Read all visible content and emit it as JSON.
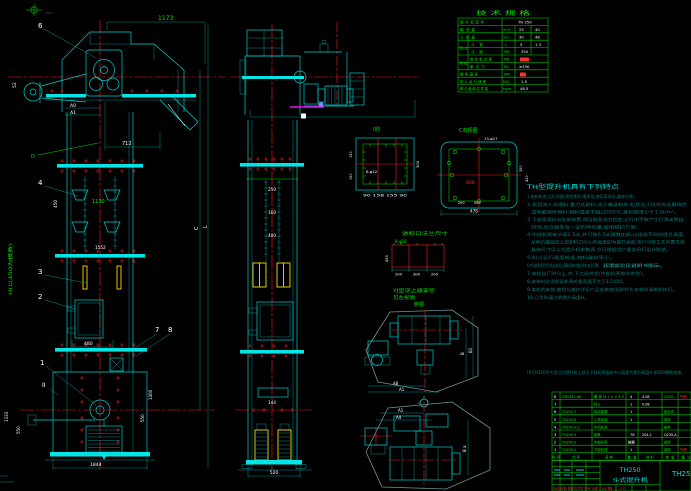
{
  "spec_table": {
    "title": "技 术 规 格",
    "rows": [
      {
        "group": "",
        "l": "提升机型号",
        "u": "",
        "v1": "TH 250",
        "v2": ""
      },
      {
        "group": "",
        "l": "输送量",
        "u": "m³/h",
        "v1": "25",
        "v2": "40"
      },
      {
        "group": "",
        "l": "斗提量",
        "u": "mm",
        "v1": "30",
        "v2": "48"
      },
      {
        "group": "料斗",
        "l": "斗 宽",
        "u": "L",
        "v1": "5",
        "v2": "1.3"
      },
      {
        "group": "",
        "l": "斗 距",
        "u": "MM",
        "v1": "350",
        "v2": ""
      },
      {
        "group": "电机",
        "l": "电动机功率",
        "u": "KW",
        "v1": "▇▇▇",
        "v2": ""
      },
      {
        "group": "",
        "l": "牵引力",
        "u": "KN",
        "v1": "≥330",
        "v2": ""
      },
      {
        "group": "",
        "l": "链条直径",
        "u": "MM",
        "v1": "▇▇",
        "v2": ""
      },
      {
        "group": "",
        "l": "料斗运行速度",
        "u": "M/S",
        "v1": "1.5",
        "v2": ""
      },
      {
        "group": "",
        "l": "牵引链单位质量",
        "u": "kg/m",
        "v1": "48.5",
        "v2": ""
      }
    ]
  },
  "notes": {
    "title": "TH型提升机具有下列特点",
    "lines": [
      "1.结构先进,运行平稳,密封性好,噪声低,使用寿命长,维修方便。",
      "2.采用流入式喂料,重力式卸料,适于输送粉状,粒状及小块状的无磨琢性",
      "或半磨琢性物料,物料温度不超过250℃,堆积密度小于1.5t/m³。",
      "3.下部采用自动张紧装置,保证链条张力恒定,运行中不致产生打滑或脱链,",
      "同时,允许链条有一定的伸长量,使用维护方便。",
      "4.中部机壳每节高2.5米,并可按0.5米模数加高,以组成不同的提升高度,",
      "从地坑基础至上部卸料口中心的高度即为提升高度,用户可按工艺布置选用,",
      "具体尺寸见斗式提升机参数表,亦可根据用户要求另行设计制造。",
      "5.料斗运行速度较低,物料破碎率小。",
      "6.传动装置采用YJ型逆止器,防止满载停车时链条逆转,安全可靠,",
      "7.本机出厂时分上,中,下三段供货(中部机壳按节供货)。",
      "8.安装时必须保证机壳的垂直度不大于1/1000。",
      "9.本机的安装,使用与维护详见产品安装使用说明书,安装时请参照执行。",
      "10.订货时请注明提升高度H。"
    ],
    "highlight": "润滑部位见说明书图示。",
    "footer": "(9)TH250中大型斗式提升机上部与下部机壳链轮中心距即为提升高度H,按450模数递增。"
  },
  "parts_table": {
    "headers": [
      "件号",
      "代  号",
      "名  称",
      "数量",
      "材  料",
      "单重",
      "备注"
    ],
    "rows": [
      {
        "no": "8",
        "code": "GB5782-86",
        "name": "螺栓M20×85",
        "qty": "4",
        "mat": "Q235",
        "wt": "4.08",
        "note": "外购"
      },
      {
        "no": "7",
        "code": "",
        "name": "料斗",
        "qty": "1",
        "mat": "",
        "wt": "0.08",
        "note": ""
      },
      {
        "no": "6",
        "code": "TH250.7",
        "name": "传动装置",
        "qty": "1",
        "mat": "组合件",
        "wt": "",
        "note": ""
      },
      {
        "no": "5",
        "code": "TH250.6",
        "name": "上部区段",
        "qty": "1",
        "mat": "部件",
        "wt": "",
        "note": ""
      },
      {
        "no": "4",
        "code": "TH250.4.5",
        "name": "中间机壳",
        "qty": "",
        "mat": "部件",
        "wt": "",
        "note": ""
      },
      {
        "no": "3",
        "code": "TH250.3",
        "name": "链条",
        "qty": "78",
        "mat": "Q235-A",
        "wt": "204.2",
        "note": ""
      },
      {
        "no": "2",
        "code": "TH250.2",
        "name": "中部机壳",
        "qty": "按需",
        "mat": "部件",
        "wt": "",
        "note": ""
      },
      {
        "no": "1",
        "code": "TH250.1",
        "name": "下部区段",
        "qty": "1",
        "mat": "部件",
        "wt": "",
        "note": "外购"
      }
    ]
  },
  "title_block": {
    "model": "TH250",
    "product": "斗式提升机",
    "drawing_no": "TH250",
    "rev_row": "标记 处数 更改文件号 签字 日期",
    "scale": "比例 1:10"
  },
  "balloons": {
    "b1": "1",
    "b2": "2",
    "b3": "3",
    "b4": "4",
    "b6": "6",
    "b7": "7",
    "b8": "8"
  },
  "dims": {
    "d1173": "1173",
    "d712": "712",
    "dA0": "A0",
    "dA1": "A1",
    "d52": "52",
    "d480": "480",
    "d1844": "1844",
    "d450": "450",
    "d1130": "1130",
    "d1552": "1552",
    "hModule": "H(以450为模数)",
    "d1333": "1333",
    "d550L": "550",
    "d1400": "1400",
    "d550R": "550",
    "letterC": "C",
    "letterL": "L",
    "sec": "II",
    "dD": "D",
    "mid250": "250",
    "mid160": "160",
    "mid400": "400",
    "mid144": "144",
    "mid520": "520",
    "f1_label": "I向",
    "f1_holes": "8-φ12",
    "f1_bottom": "90 158 155 90",
    "f1_right": "300",
    "f1_l1": "150",
    "f1_l2": "150",
    "c_label": "C向视图",
    "c_holes": "13-φ17",
    "c_600": "600",
    "c_478": "478",
    "c_350": "350",
    "c_420": "420",
    "c_b1": "250",
    "c_b2": "500",
    "feed_title": "进料口法兰尺寸",
    "feed_holes": "8-φ18",
    "feed_w1": "200",
    "feed_w2": "300",
    "feed_w3": "200",
    "feed_h": "450",
    "yj1": "YJ型逆止器安装",
    "yj2": "见左视图",
    "plan1_label": "俯视",
    "p1_a1": "A8",
    "p1_a2": "A1",
    "p1_b": "B",
    "p1_b1": "B1",
    "p2_a1": "A1",
    "p2_a2": "A4",
    "p2_b": "B a"
  }
}
